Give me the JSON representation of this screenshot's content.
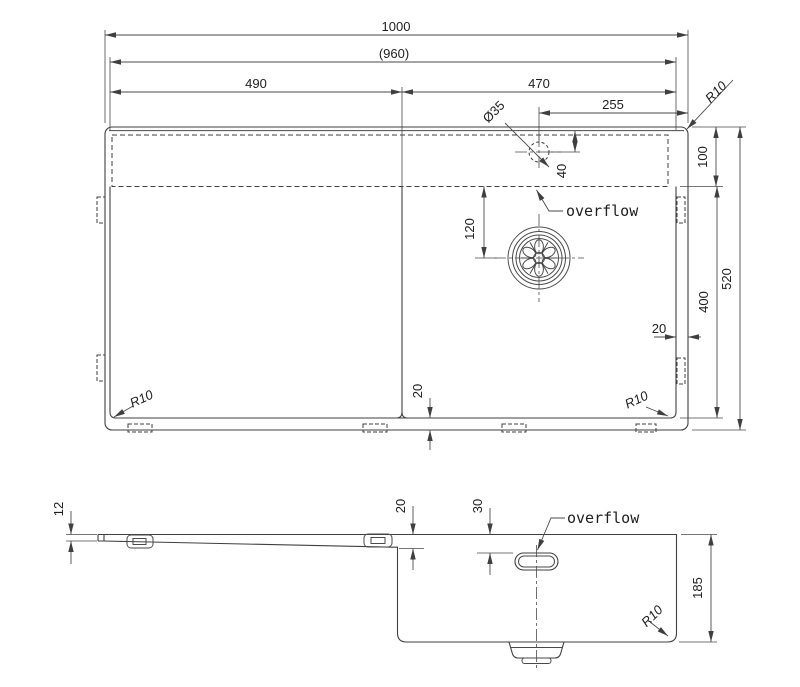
{
  "drawing": {
    "type": "sink-technical-drawing",
    "colors": {
      "line": "#3f3f3f",
      "text": "#1e1e1e",
      "background": "#ffffff"
    },
    "top_view": {
      "dims": {
        "overall_width": "1000",
        "opening_width": "(960)",
        "drainboard_width": "490",
        "bowl_width": "470",
        "tap_hole_offset": "255",
        "tap_hole_diameter": "Ø35",
        "corner_top_right": "R10",
        "overflow_channel_height": "100",
        "tap_hole_down_offset": "40",
        "drain_offset": "120",
        "rim_gap_right": "20",
        "bowl_height": "400",
        "overall_height": "520",
        "rim_gap_bottom": "20",
        "corner_bottom_left": "R10",
        "corner_bottom_right": "R10"
      },
      "overflow_label": "overflow"
    },
    "side_view": {
      "dims": {
        "rim_lip_height": "12",
        "drainboard_step_depth": "20",
        "overflow_top_offset": "30",
        "bowl_depth": "185",
        "corner_bottom_right": "R10"
      },
      "overflow_label": "overflow"
    }
  }
}
